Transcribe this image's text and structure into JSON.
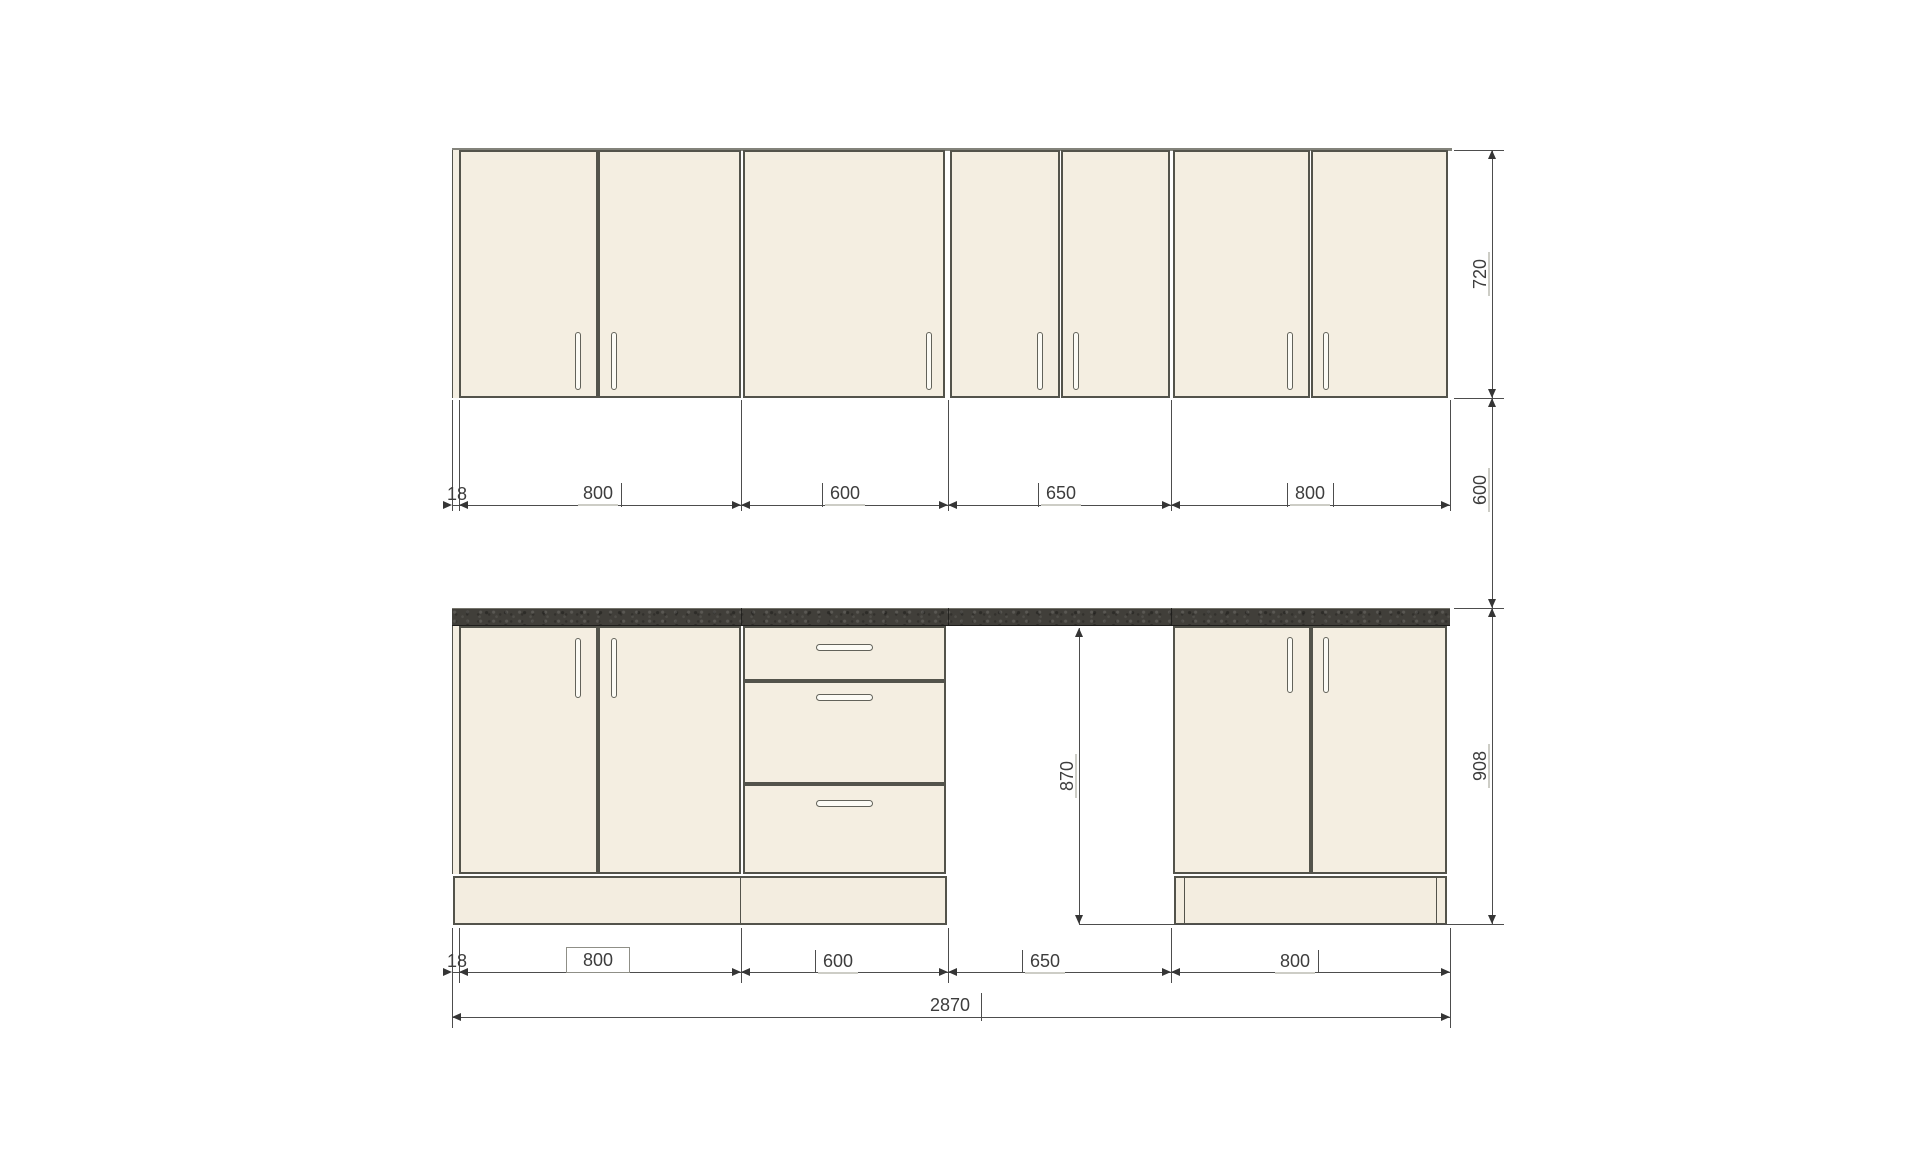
{
  "colors": {
    "cabinet_front": "#f4eee1",
    "countertop": "#413f3a",
    "outline": "#53534b",
    "dimension_text": "#3d3d3d"
  },
  "dimensions": {
    "upper_row": {
      "filler": "18",
      "cab1": "800",
      "cab2": "600",
      "cab3": "650",
      "cab4": "800"
    },
    "base_row": {
      "filler": "18",
      "cab1": "800",
      "cab2": "600",
      "cab3": "650",
      "cab4": "800"
    },
    "total_width": "2870",
    "upper_cabinet_height": "720",
    "wall_gap_height": "600",
    "base_unit_height": "908",
    "appliance_niche_height": "870"
  }
}
